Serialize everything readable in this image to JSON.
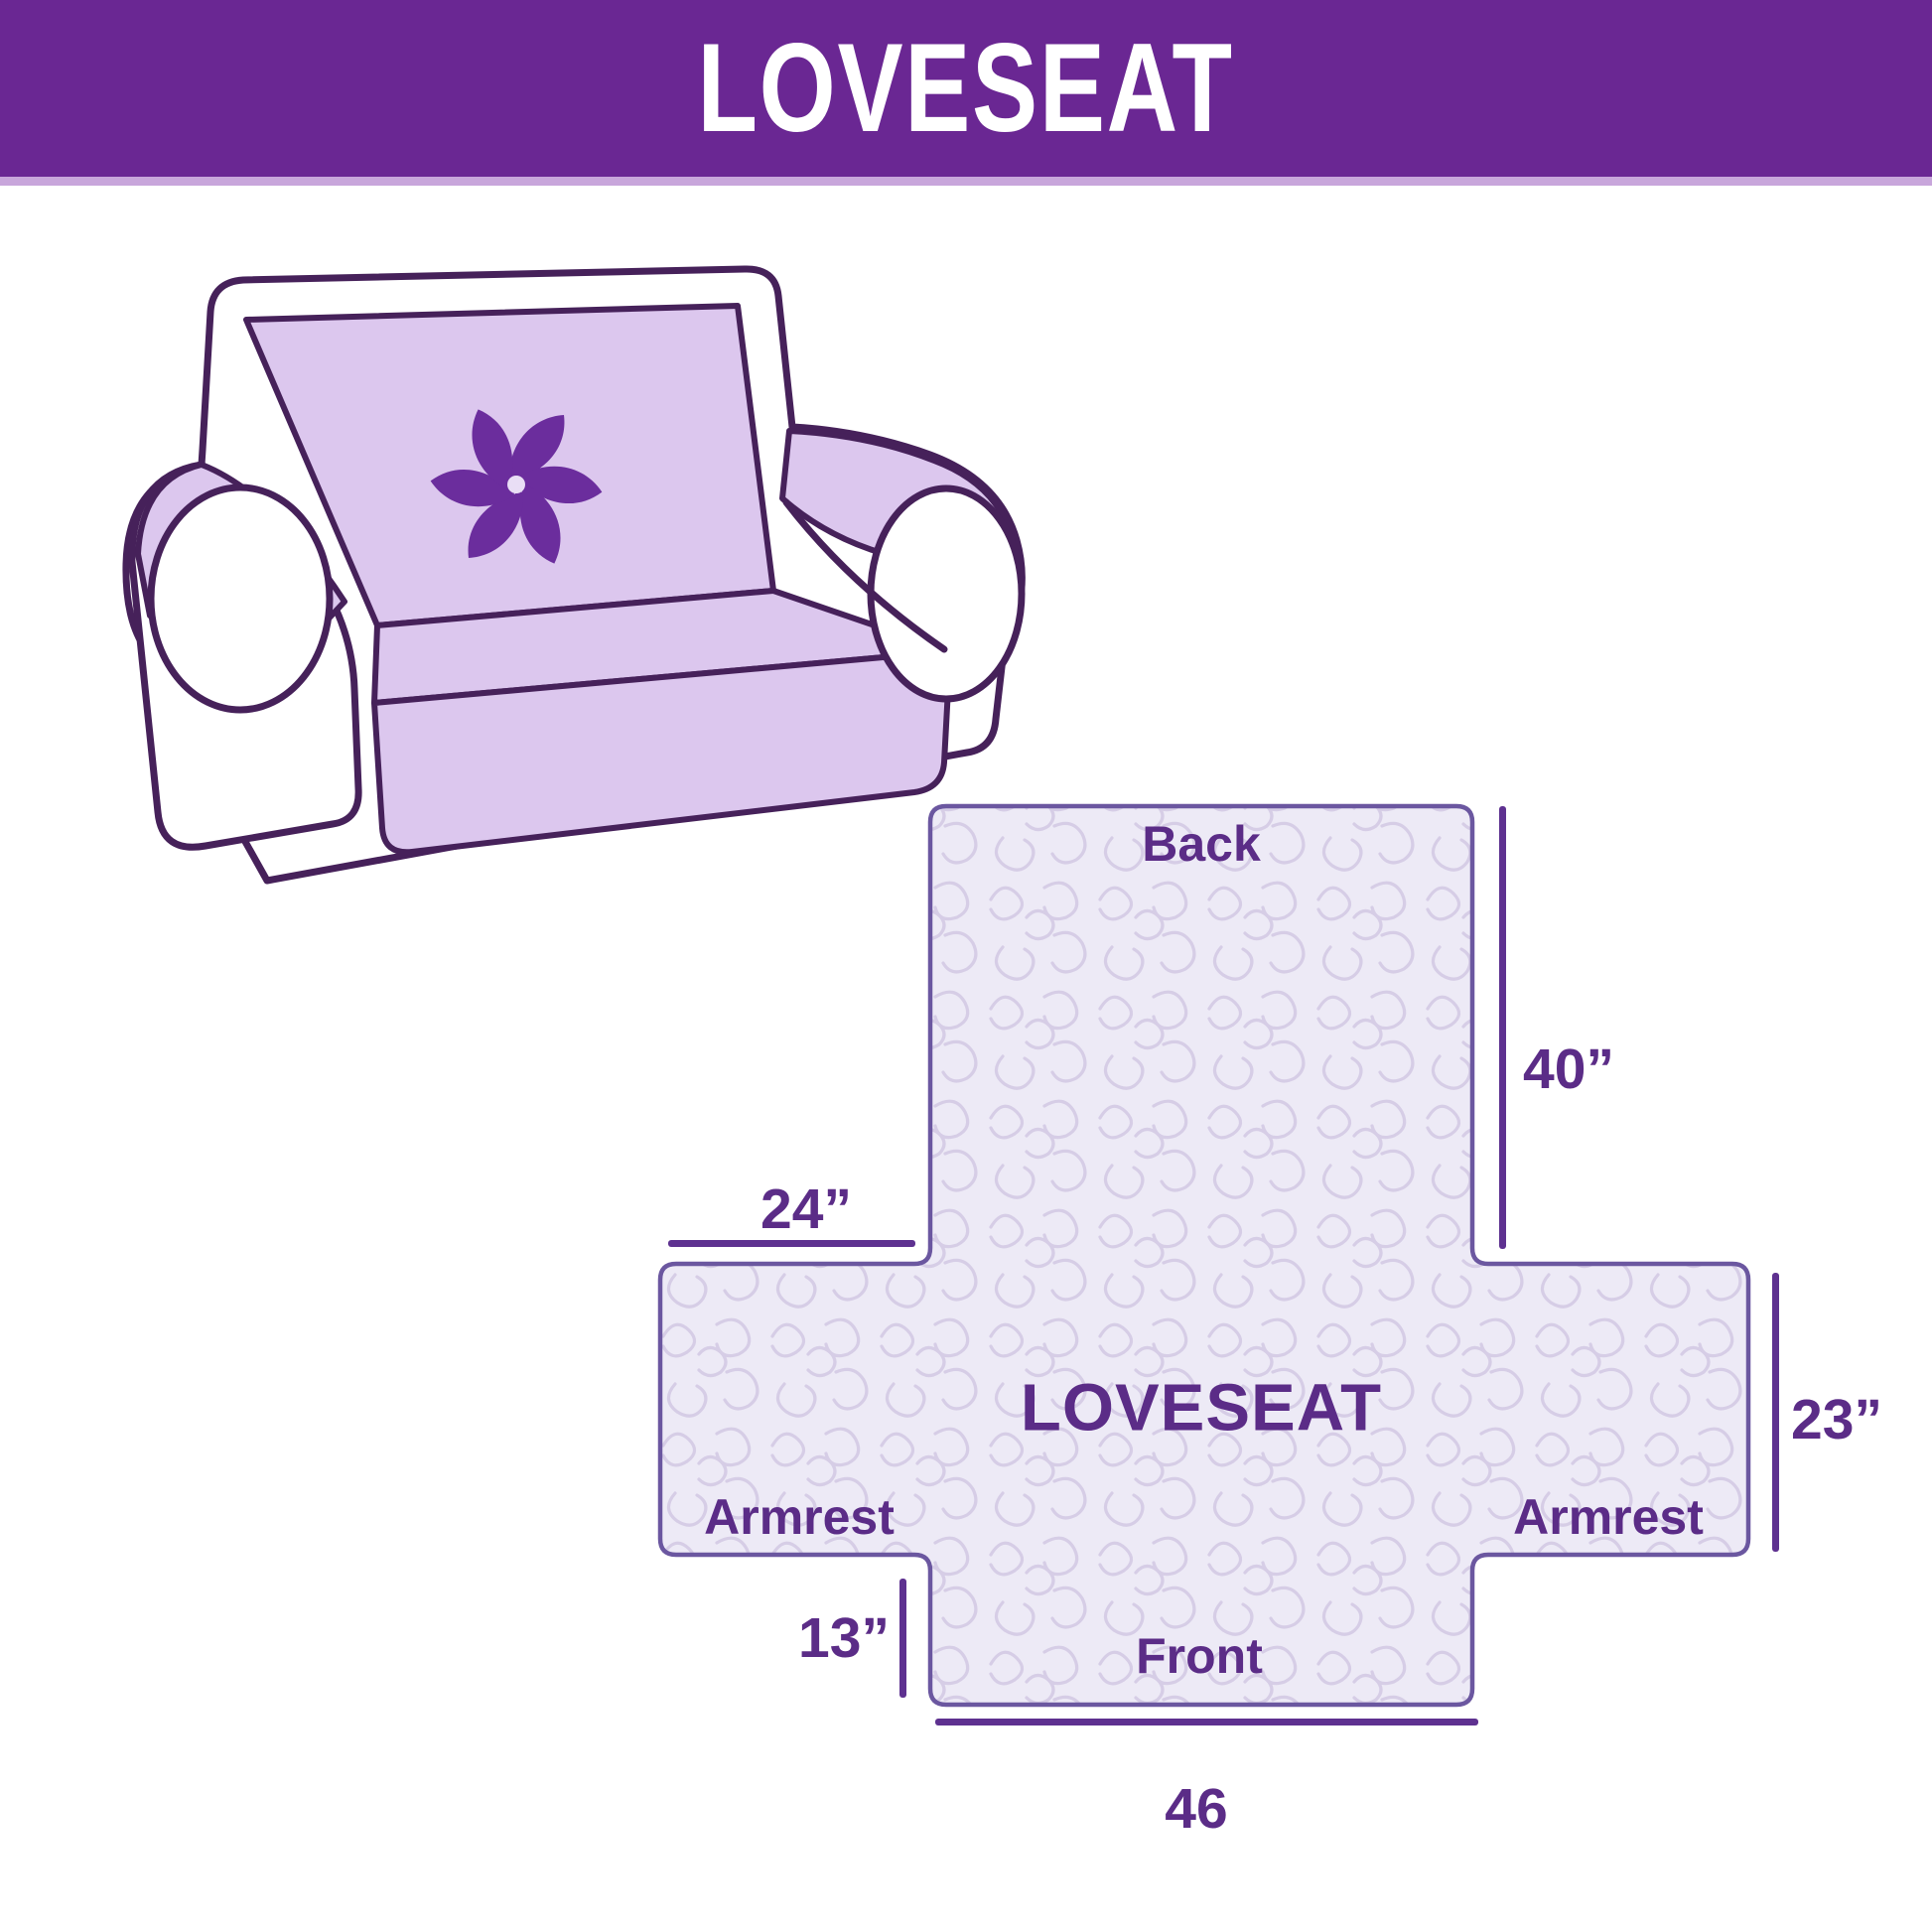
{
  "banner": {
    "title": "LOVESEAT"
  },
  "illustration": {
    "description": "loveseat sofa with light purple protective cover",
    "logo": "pinwheel"
  },
  "diagram": {
    "center_label": "LOVESEAT",
    "sections": {
      "back": "Back",
      "front": "Front",
      "armrest_left": "Armrest",
      "armrest_right": "Armrest"
    },
    "dimensions": {
      "back_height": "40”",
      "armrest_top_width": "24”",
      "armrest_side_height": "23”",
      "front_skirt_height": "13”",
      "front_width": "46"
    }
  },
  "colors": {
    "banner_purple": "#6a2793",
    "banner_strip": "#c8a6db",
    "label_purple": "#5b2c87",
    "dimension_line": "#5e3190",
    "cover_fill": "#edeaf6",
    "quilt_line": "#d6cde6",
    "shape_border": "#6b57a0",
    "sofa_outline": "#46215a",
    "sofa_cover": "#dcc7ee",
    "pinwheel": "#6b2d9d"
  }
}
